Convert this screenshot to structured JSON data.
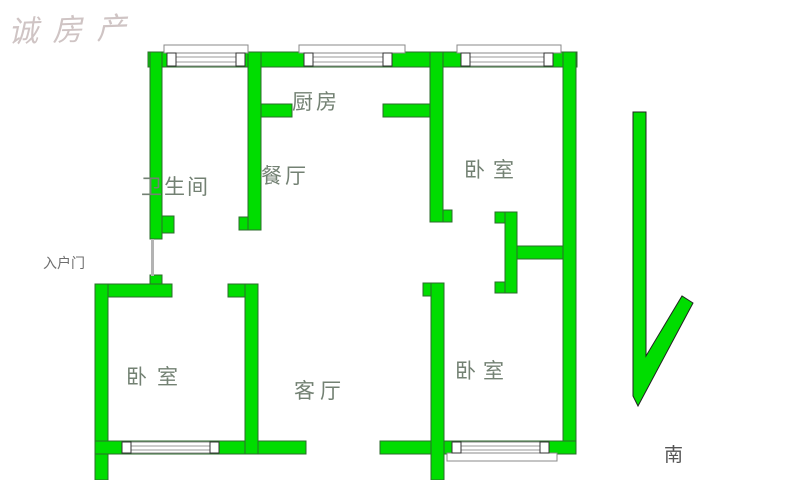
{
  "watermark": "诚房产",
  "rooms": [
    {
      "id": "kitchen",
      "label": "厨房"
    },
    {
      "id": "dining",
      "label": "餐厅"
    },
    {
      "id": "bathroom",
      "label": "卫生间"
    },
    {
      "id": "bedroom-top-right",
      "label": "卧室"
    },
    {
      "id": "bedroom-bottom-left",
      "label": "卧室"
    },
    {
      "id": "living-room",
      "label": "客厅"
    },
    {
      "id": "bedroom-bottom-right",
      "label": "卧室"
    }
  ],
  "annotations": {
    "entrance": "入户门",
    "south": "南"
  },
  "colors": {
    "wall_fill": "#00dd00",
    "wall_outline": "#2d6b2d",
    "room_label": "#738173",
    "small_label": "#6e6e6e",
    "watermark": "#a89494",
    "background": "#ffffff"
  }
}
